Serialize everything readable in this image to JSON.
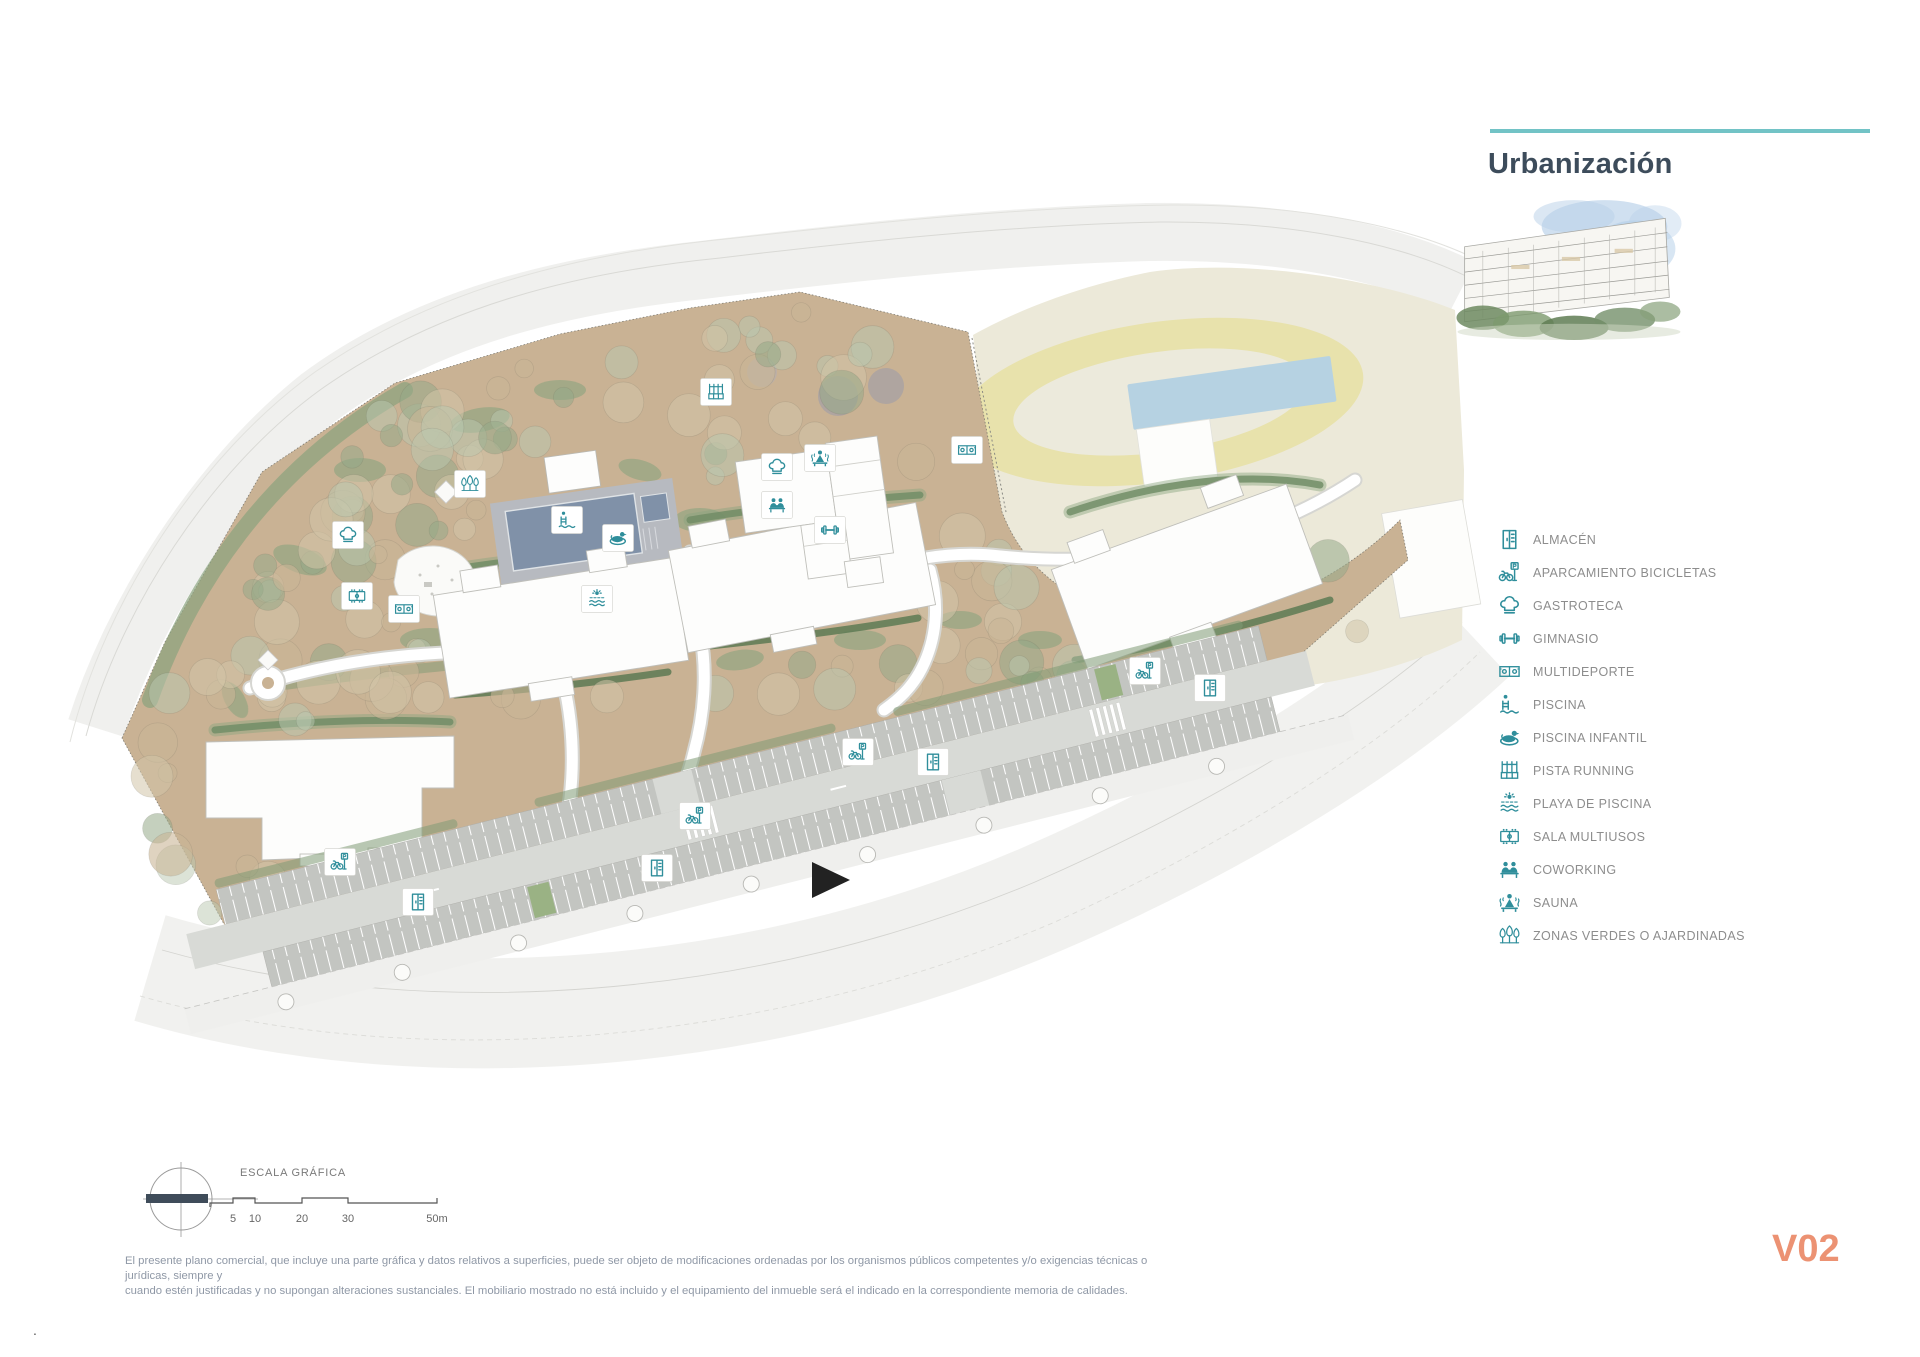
{
  "title": "Urbanización",
  "version_label": "V02",
  "footnote_dot": ".",
  "scale_bar": {
    "label": "ESCALA GRÁFICA",
    "ticks": [
      {
        "label": "5",
        "x": 233
      },
      {
        "label": "10",
        "x": 255
      },
      {
        "label": "20",
        "x": 302
      },
      {
        "label": "30",
        "x": 348
      },
      {
        "label": "50m",
        "x": 437
      }
    ]
  },
  "disclaimer": {
    "line1": "El presente plano comercial, que incluye una parte gráfica y datos relativos a superficies, puede ser objeto de modificaciones ordenadas por los organismos públicos competentes y/o exigencias técnicas o jurídicas, siempre y",
    "line2": "cuando estén justificadas y no supongan alteraciones sustanciales. El mobiliario mostrado no está incluido y el equipamiento del inmueble será el indicado en la correspondiente memoria de calidades."
  },
  "legend": {
    "items": [
      {
        "id": "almacen",
        "label": "ALMACÉN"
      },
      {
        "id": "aparcamiento-bicicletas",
        "label": "APARCAMIENTO BICICLETAS"
      },
      {
        "id": "gastroteca",
        "label": "GASTROTECA"
      },
      {
        "id": "gimnasio",
        "label": "GIMNASIO"
      },
      {
        "id": "multideporte",
        "label": "MULTIDEPORTE"
      },
      {
        "id": "piscina",
        "label": "PISCINA"
      },
      {
        "id": "piscina-infantil",
        "label": "PISCINA INFANTIL"
      },
      {
        "id": "pista-running",
        "label": "PISTA RUNNING"
      },
      {
        "id": "playa-piscina",
        "label": "PLAYA DE PISCINA"
      },
      {
        "id": "sala-multiusos",
        "label": "SALA MULTIUSOS"
      },
      {
        "id": "coworking",
        "label": "COWORKING"
      },
      {
        "id": "sauna",
        "label": "SAUNA"
      },
      {
        "id": "zonas-verdes",
        "label": "ZONAS VERDES O AJARDINADAS"
      }
    ]
  },
  "map": {
    "icons": [
      {
        "type": "gastroteca",
        "x": 348,
        "y": 535
      },
      {
        "type": "sala-multiusos",
        "x": 357,
        "y": 596
      },
      {
        "type": "multideporte",
        "x": 404,
        "y": 609
      },
      {
        "type": "zonas-verdes",
        "x": 470,
        "y": 484
      },
      {
        "type": "piscina",
        "x": 567,
        "y": 520
      },
      {
        "type": "piscina-infantil",
        "x": 618,
        "y": 538
      },
      {
        "type": "playa-piscina",
        "x": 597,
        "y": 599
      },
      {
        "type": "pista-running",
        "x": 716,
        "y": 392
      },
      {
        "type": "gastroteca",
        "x": 777,
        "y": 467
      },
      {
        "type": "sauna",
        "x": 820,
        "y": 458
      },
      {
        "type": "coworking",
        "x": 777,
        "y": 505
      },
      {
        "type": "gimnasio",
        "x": 830,
        "y": 530
      },
      {
        "type": "multideporte",
        "x": 967,
        "y": 450
      },
      {
        "type": "aparcamiento-bicicletas",
        "x": 340,
        "y": 862
      },
      {
        "type": "almacen",
        "x": 418,
        "y": 902
      },
      {
        "type": "almacen",
        "x": 657,
        "y": 868
      },
      {
        "type": "aparcamiento-bicicletas",
        "x": 695,
        "y": 816
      },
      {
        "type": "aparcamiento-bicicletas",
        "x": 858,
        "y": 752
      },
      {
        "type": "almacen",
        "x": 933,
        "y": 762
      },
      {
        "type": "aparcamiento-bicicletas",
        "x": 1145,
        "y": 671
      },
      {
        "type": "almacen",
        "x": 1210,
        "y": 688
      }
    ]
  },
  "colors": {
    "accent_teal": "#72c3c6",
    "icon_teal": "#2f8e9b",
    "title": "#3d4c5b",
    "version": "#ec9273",
    "legend_text": "#8d8d8d",
    "disclaimer_text": "#8f98a6",
    "landscape_tan": "#c9b294",
    "green_dark": "#5d7a54",
    "green_mid": "#8ba37f",
    "cream_zone": "#ece9d9",
    "track_yellow": "#e8e2ac",
    "court_blue": "#b6d2e2",
    "pool_water": "#8091a8"
  }
}
